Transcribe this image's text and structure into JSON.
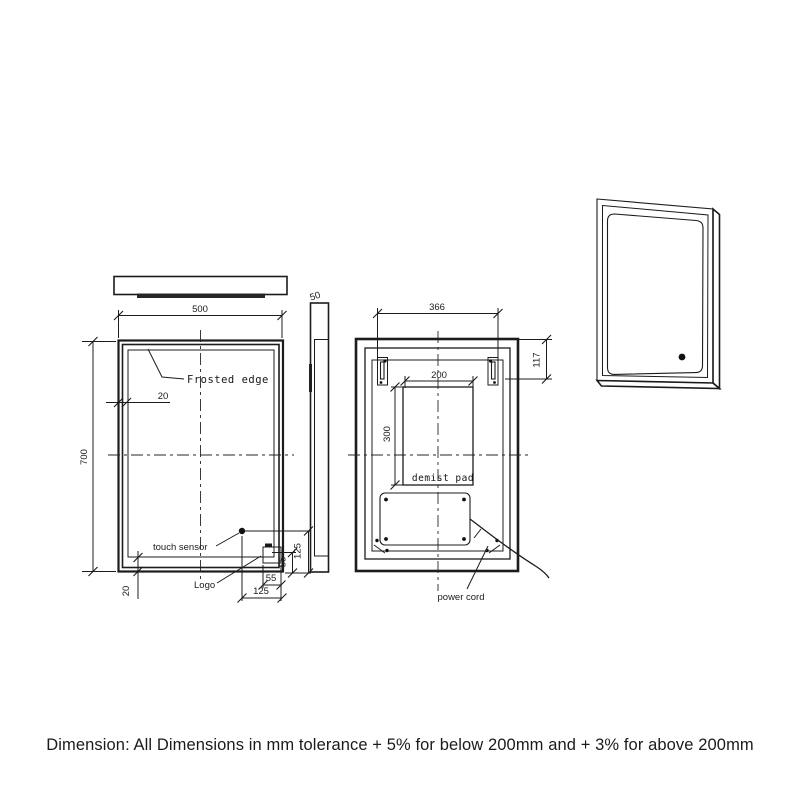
{
  "caption": "Dimension: All Dimensions in mm tolerance + 5% for below 200mm and + 3% for above 200mm",
  "front_view": {
    "frosted_edge_label": "Frosted edge",
    "touch_sensor_label": "touch sensor",
    "logo_label": "Logo",
    "dim_width": "500",
    "dim_height": "700",
    "dim_edge_top": "20",
    "dim_edge_bottom": "20",
    "dim_sensor_from_bottom": "125",
    "dim_sensor_from_right": "125",
    "dim_logo_height": "55",
    "dim_logo_width": "55"
  },
  "side_view": {
    "dim_depth": "50"
  },
  "back_view": {
    "demist_pad_label": "demist pad",
    "power_cord_label": "power cord",
    "dim_bracket_span": "366",
    "dim_bracket_from_top": "117",
    "dim_pad_width": "200",
    "dim_pad_height": "300"
  },
  "line_color": "#1c1c1c",
  "background_color": "#ffffff"
}
